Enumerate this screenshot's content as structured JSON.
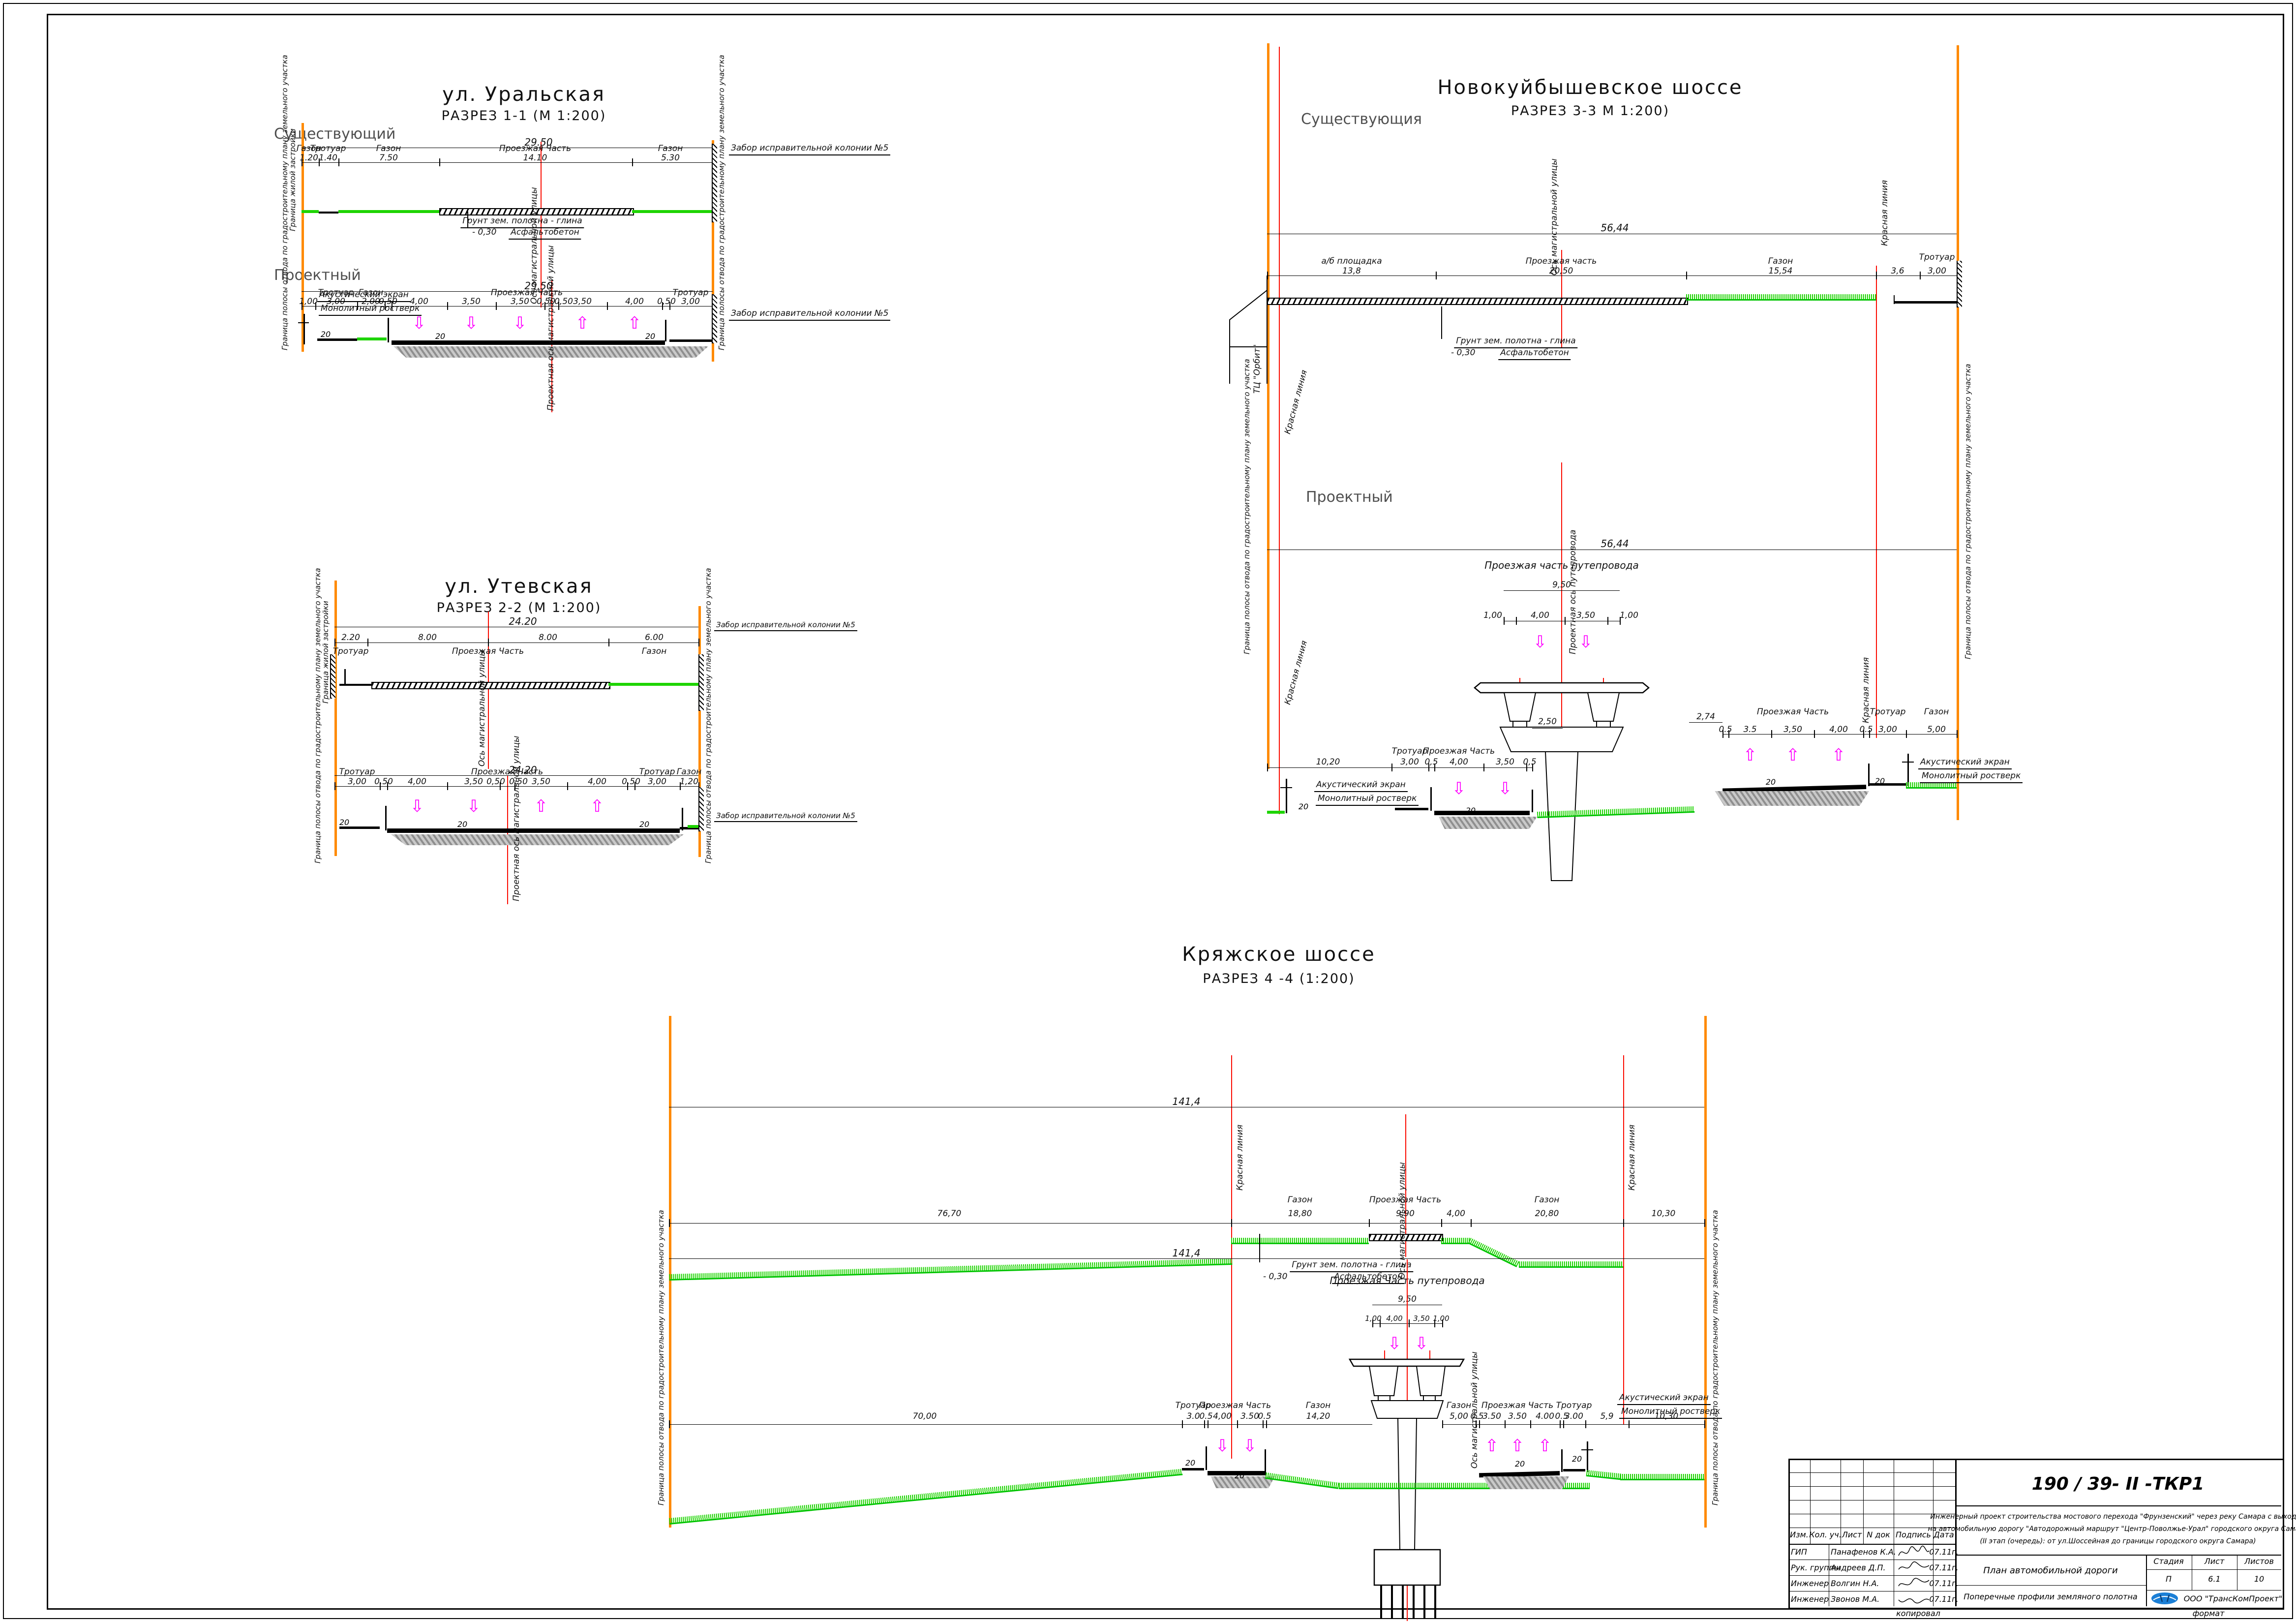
{
  "g": {
    "down": "⇩",
    "up": "⇧",
    "slope": "20"
  },
  "colors": {
    "boundary_orange": "#ff8a00",
    "axis_red": "#fb0b00",
    "lawn_green": "#1ed400",
    "arrow_magenta": "#ff00ff",
    "logo_blue": "#1b7fd6"
  },
  "s1": {
    "title": "ул. Уральская",
    "razrez": "РАЗРЕЗ 1-1  (М 1:200)",
    "existing": "Существующий",
    "design": "Проектный",
    "ex": {
      "total": "29.50",
      "labels": [
        "Газон",
        "Тротуар",
        "Газон",
        "Проезжая Часть",
        "Газон"
      ],
      "dims": [
        "1.20",
        "1.40",
        "7.50",
        "14.10",
        "5.30"
      ]
    },
    "de": {
      "total": "29,50",
      "labels": [
        "Тротуар",
        "Газон",
        "Проезжая Часть",
        "Тротуар"
      ],
      "dims": [
        "1,00",
        "3,00",
        "2,00",
        "0,50",
        "4,00",
        "3,50",
        "3,50",
        "0,50",
        "0,50",
        "3,50",
        "4,00",
        "0,50",
        "3,00"
      ]
    },
    "axis_ex": "Ось магистральной улицы",
    "axis_de": "Проектная ось магистральной улицы",
    "note1": "Грунт зем. полотна - глина",
    "note2": "- 0,30",
    "note3": "Асфальтобетон",
    "screen": "Акустический экран",
    "rostverk": "Монолитный ростверк",
    "border_left1": "Граница жилой застройки",
    "border_left2": "Граница полосы отвода по градостроительному плану земельного участка",
    "border_right": "Граница полосы отвода по градостроительному плану земельного участка",
    "fence": "Забор исправительной колонии №5"
  },
  "s2": {
    "title": "ул. Утевская",
    "razrez": "РАЗРЕЗ  2-2   (М 1:200)",
    "ex": {
      "total": "24.20",
      "labels": [
        "Тротуар",
        "Проезжая Часть",
        "Газон"
      ],
      "dims": [
        "2.20",
        "8.00",
        "8.00",
        "6.00"
      ]
    },
    "de": {
      "total": "24.20",
      "labels": [
        "Тротуар",
        "Проезжая Часть",
        "Тротуар",
        "Газон"
      ],
      "dims": [
        "3,00",
        "0,50",
        "4,00",
        "3,50",
        "0,50",
        "0,50",
        "3,50",
        "4,00",
        "0,50",
        "3,00",
        "1,20"
      ]
    },
    "axis_ex": "Ось магистральной улицы",
    "axis_de": "Проектная ось магистральной улицы",
    "border_left1": "Граница жилой застройки",
    "border_left2": "Граница полосы отвода по градостроительному плану земельного участка",
    "border_right": "Граница полосы отвода по градостроительному плану земельного участка",
    "fence": "Забор исправительной колонии №5"
  },
  "s3": {
    "title": "Новокуйбышевское шоссе",
    "razrez": "РАЗРЕЗ 3-3 М 1:200)",
    "existing": "Существующия",
    "design": "Проектный",
    "ex": {
      "total": "56,44",
      "labels": [
        "а/б площадка",
        "Проезжая часть",
        "Газон",
        "Тротуар"
      ],
      "dims": [
        "13,8",
        "20,50",
        "15,54",
        "3,6",
        "3,00"
      ]
    },
    "de_total": "56,44",
    "overpass": "Проезжая часть путепровода",
    "b_total": "9,50",
    "b_dims": [
      "1,00",
      "4,00",
      "3,50",
      "1,00"
    ],
    "dim250": "2,50",
    "left_labels": [
      "Тротуар",
      "Проезжая Часть"
    ],
    "left_dims": [
      "10,20",
      "3,00",
      "0,5",
      "4,00",
      "3,50",
      "0,5"
    ],
    "right_labels": [
      "Проезжая Часть",
      "Тротуар",
      "Газон"
    ],
    "right_dims": [
      "2,74",
      "0.5",
      "3.5",
      "3,50",
      "4,00",
      "0.5",
      "3,00",
      "5,00"
    ],
    "axis_ex": "Ось магистральной улицы",
    "axis_bridge": "Проектная ось путепровода",
    "red_line": "Красная линия",
    "tc": "ТЦ \"Орбит\"",
    "note1": "Грунт зем. полотна - глина",
    "note2": "- 0,30",
    "note3": "Асфальтобетон",
    "screen": "Акустический экран",
    "rostverk": "Монолитный ростверк",
    "border": "Граница полосы отвода по градостроительному плану земельного участка"
  },
  "s4": {
    "title": "Кряжское  шоссе",
    "razrez": "РАЗРЕЗ 4 -4 (1:200)",
    "ex": {
      "total": "141,4",
      "labels": [
        "Газон",
        "Проезжая Часть",
        "Газон"
      ],
      "dims": [
        "76,70",
        "18,80",
        "9,90",
        "4,00",
        "20,80",
        "10,30"
      ]
    },
    "de_total": "141,4",
    "overpass": "Проезжая Часть путепровода",
    "b_total": "9,50",
    "b_dims": [
      "1,00",
      "4,00",
      "3,50",
      "1,00"
    ],
    "left_labels": [
      "Тротуар",
      "Проезжая Часть",
      "Газон"
    ],
    "left_dims": [
      "70,00",
      "3.0",
      "0.5",
      "4,00",
      "3.50",
      "0.5",
      "14,20"
    ],
    "gazon_label": "Газон",
    "gazon_dim": "5,00",
    "right_labels": [
      "Проезжая Часть",
      "Тротуар"
    ],
    "right_dims": [
      "0.5",
      "3.50",
      "3.50",
      "4.00",
      "0.5",
      "3.00",
      "5,9",
      "10,30"
    ],
    "axis": "Ось магистральной улицы",
    "red_line": "Красная линия",
    "note1": "Грунт зем. полотна - глина",
    "note2": "- 0,30",
    "note3": "Асфальтобетон",
    "screen": "Акустический экран",
    "rostverk": "Монолитный ростверк",
    "border_left": "Граница полосы отвода по градостроительному плану земельного участка",
    "border_right": "Граница полосы отвода по градостроительному плану земельного участка"
  },
  "stamp": {
    "doc": "190 / 39- II -ТКР1",
    "desc1": "Инженерный проект строительства мостового перехода \"Фрунзенский\" через реку Самара с выходом",
    "desc2": "на автомобильную дорогу \"Автодорожный маршрут \"Центр-Поволжье-Урал\" городского округа Самара",
    "desc3": "(II этап (очередь): от ул.Шоссейная до границы городского округа Самара)",
    "cols": [
      "Изм.",
      "Кол. уч.",
      "Лист",
      "N док",
      "Подпись",
      "Дата"
    ],
    "rows": [
      {
        "role": "ГИП",
        "name": "Панафенов К.А.",
        "date": "07.11г."
      },
      {
        "role": "Рук. группы",
        "name": "Андреев Д.П.",
        "date": "07.11г."
      },
      {
        "role": "Инженер",
        "name": "Волгин Н.А.",
        "date": "07.11г."
      },
      {
        "role": "Инженер",
        "name": "Звонов М.А.",
        "date": "07.11г."
      }
    ],
    "plan": "План автомобильной дороги",
    "profili": "Поперечные профили земляного полотна",
    "stadia_h": "Стадия",
    "list_h": "Лист",
    "listov_h": "Листов",
    "stadia": "П",
    "list": "6.1",
    "listov": "10",
    "company": "ООО \"ТрансКомПроект\"",
    "kopiroval": "копировал",
    "format": "формат"
  }
}
